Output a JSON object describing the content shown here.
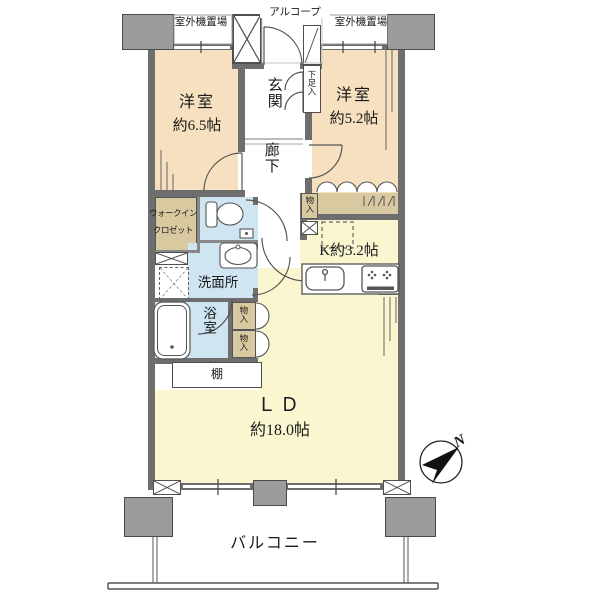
{
  "labels": {
    "outdoor_unit_left": "室外機置場",
    "alcove": "アルコープ",
    "outdoor_unit_right": "室外機置場",
    "entrance": "玄関",
    "shoe_cabinet": "下足入",
    "bedroom1_name": "洋室",
    "bedroom1_size": "約6.5帖",
    "bedroom2_name": "洋室",
    "bedroom2_size": "約5.2帖",
    "corridor": "廊下",
    "walkin_line1": "ウォークイン",
    "walkin_line2": "クロゼット",
    "storage": "物入",
    "kitchen": "K約3.2帖",
    "washroom": "洗面所",
    "bathroom": "浴室",
    "shelf": "棚",
    "living_name": "ＬＤ",
    "living_size": "約18.0帖",
    "balcony": "バルコニー",
    "compass_north": "N"
  },
  "colors": {
    "bedroom_fill": "#f6e0bf",
    "living_kitchen_fill": "#f9f6d0",
    "wet_area_fill": "#cfe6f2",
    "storage_fill": "#d9c9a1",
    "wall": "#6e6e6e",
    "pillar": "#9c9c9c"
  }
}
